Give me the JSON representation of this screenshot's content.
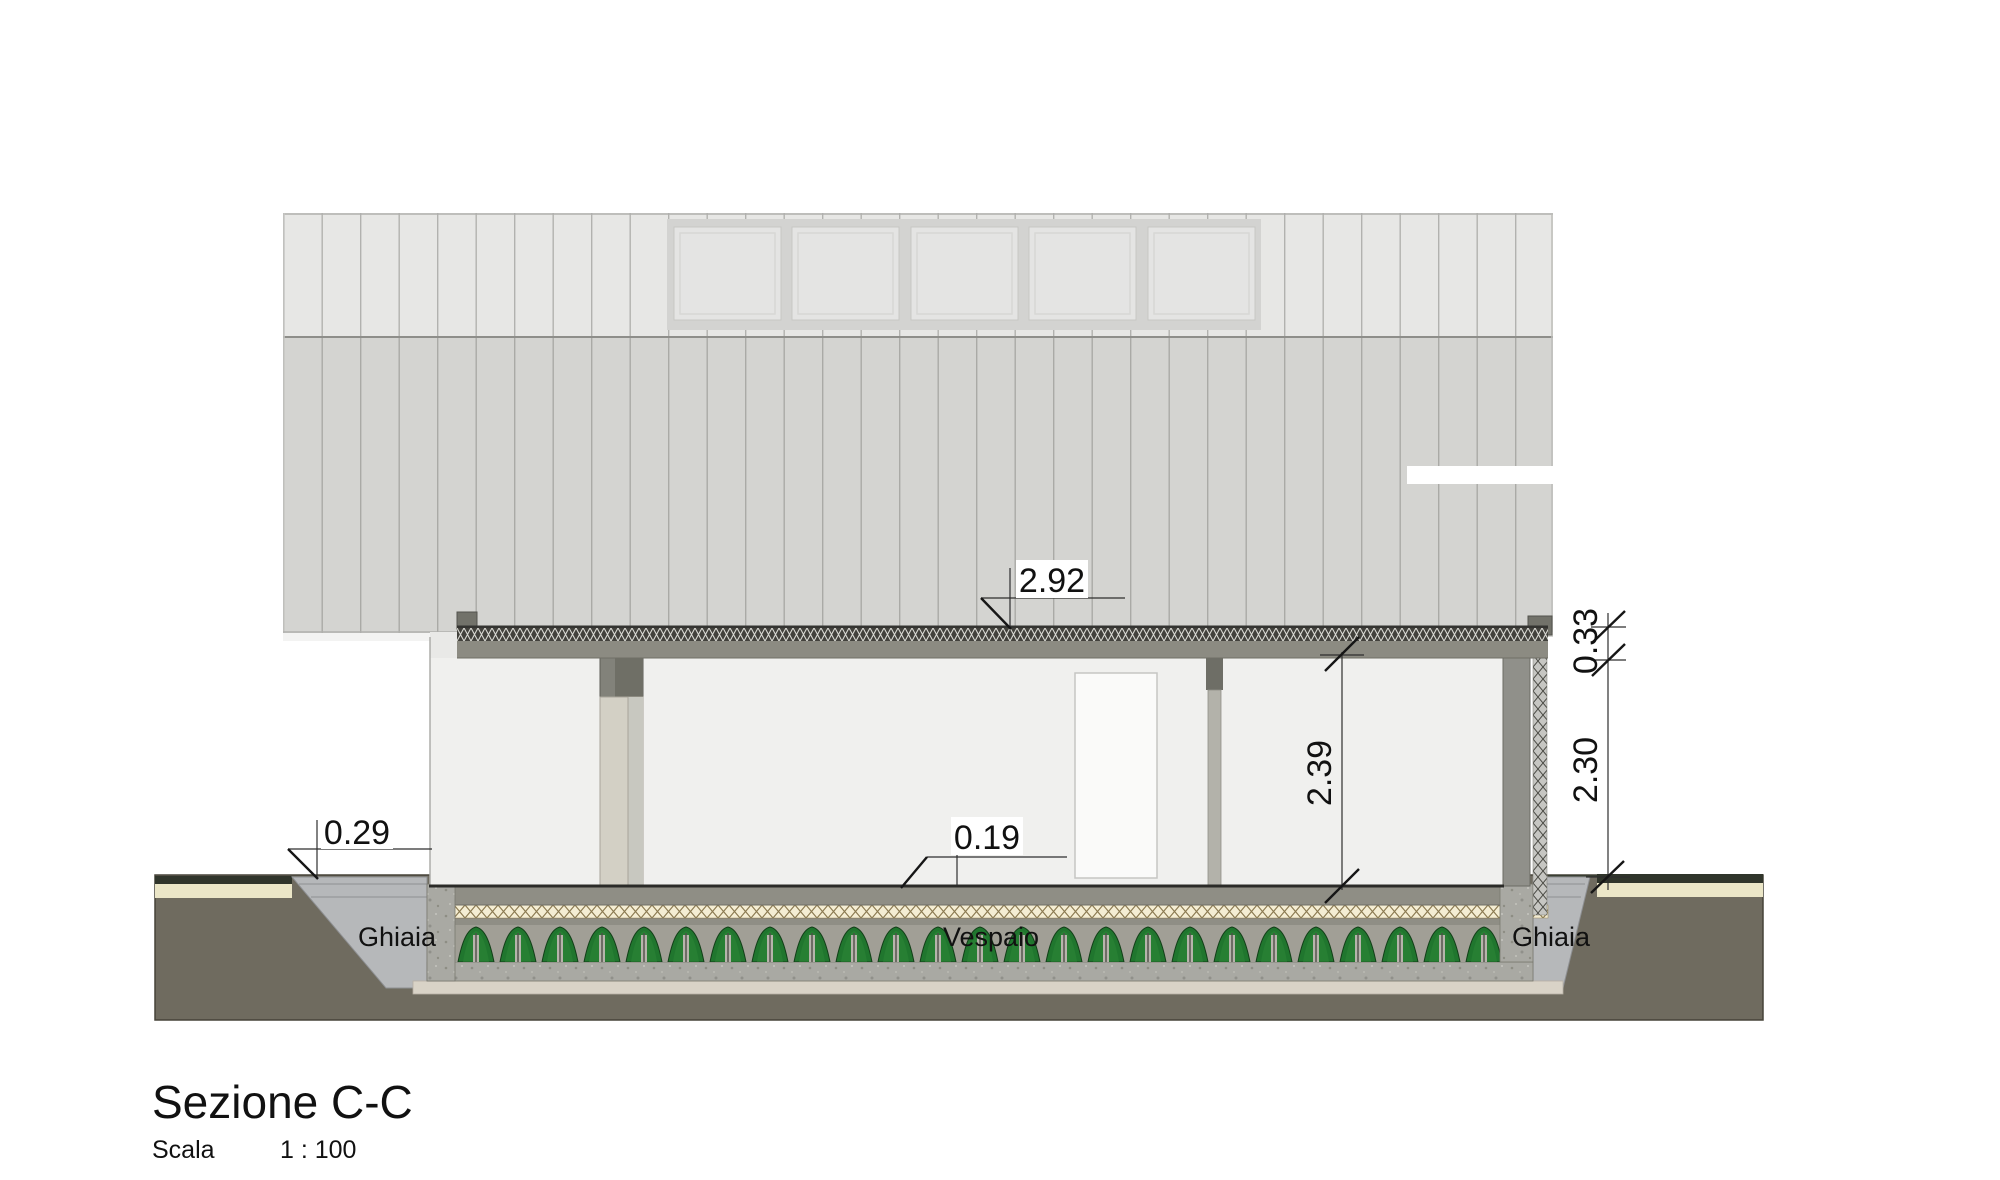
{
  "page": {
    "background": "#ffffff"
  },
  "title_block": {
    "title": "Sezione C-C",
    "scale_label": "Scala",
    "scale_value": "1 : 100"
  },
  "dimensions": {
    "roof_top_offset": "2.92",
    "roof_thickness": "0.33",
    "interior_clear_height": "2.39",
    "underside_to_ground": "2.30",
    "gravel_step": "0.29",
    "floor_slab_thickness": "0.19"
  },
  "material_labels": {
    "gravel_left": "Ghiaia",
    "crawl_space": "Vespaio",
    "gravel_right": "Ghiaia"
  },
  "colors": {
    "upper_cladding_band": "#e7e7e5",
    "lower_cladding_band": "#d4d4d1",
    "window_pane": "#e4e4e3",
    "roof_structure_band": "#8c8b82",
    "interior_wall": "#f0f0ee",
    "cut_wall_grey": "#90908a",
    "soil": "#6f6b5f",
    "topsoil": "#30352b",
    "sand_layer": "#ebe6c7",
    "gravel": "#b6b8ba",
    "concrete": "#a9a9a3",
    "floor_insulation": "#f4edd3",
    "crawlspace_green": "#20762e",
    "footing": "#d9d3c7",
    "dimension_text": "#111111"
  }
}
